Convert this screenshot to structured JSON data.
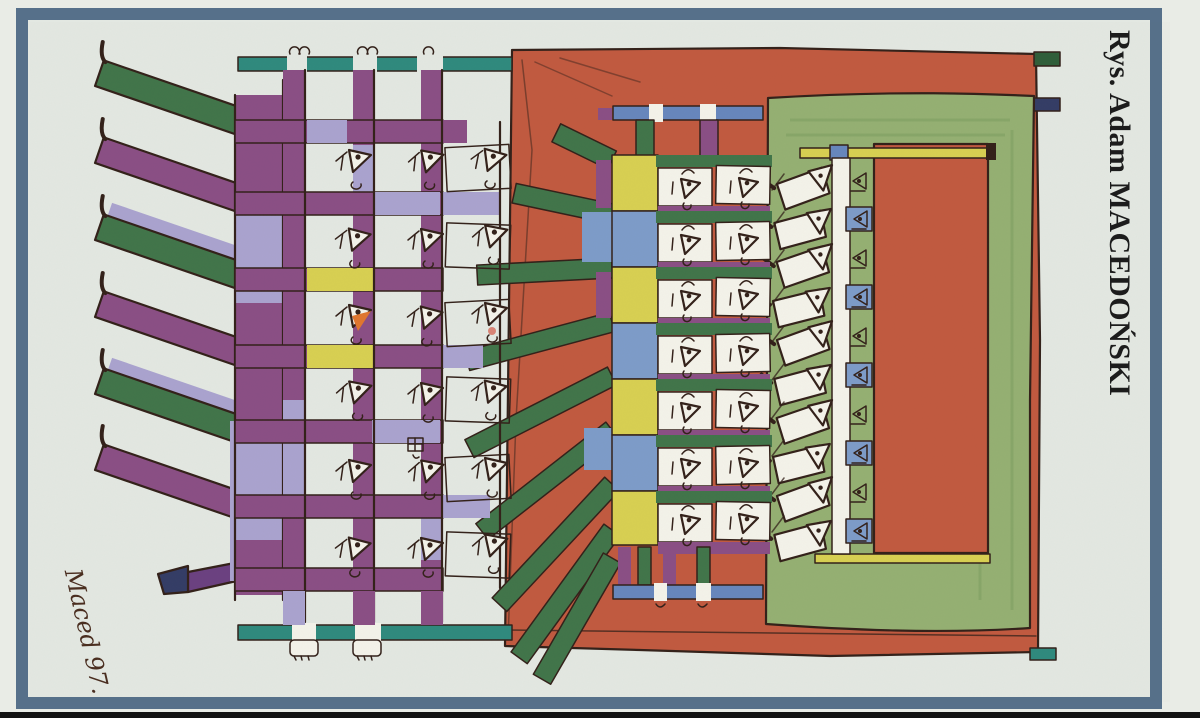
{
  "artwork": {
    "credit": "Rys. Adam MACEDOŃSKI",
    "signature": "Maced 97."
  },
  "palette": {
    "page_bg": "#e9ece6",
    "inner_bg": "#e3e8e2",
    "frame": "#56708a",
    "paper": "#f4f3ea",
    "ink": "#33211a",
    "purple": "#8a4f85",
    "purple_dark": "#6b4181",
    "navy": "#343d66",
    "lavender": "#aaa3cf",
    "green": "#41754a",
    "green_light": "#95b073",
    "green_dark": "#2f5e3a",
    "teal": "#2f8a7e",
    "red": "#c15a40",
    "yellow": "#d8d052",
    "blue": "#7d9cc9",
    "blue_bar": "#6787bd",
    "orange": "#e0762f",
    "pink": "#d98577"
  }
}
